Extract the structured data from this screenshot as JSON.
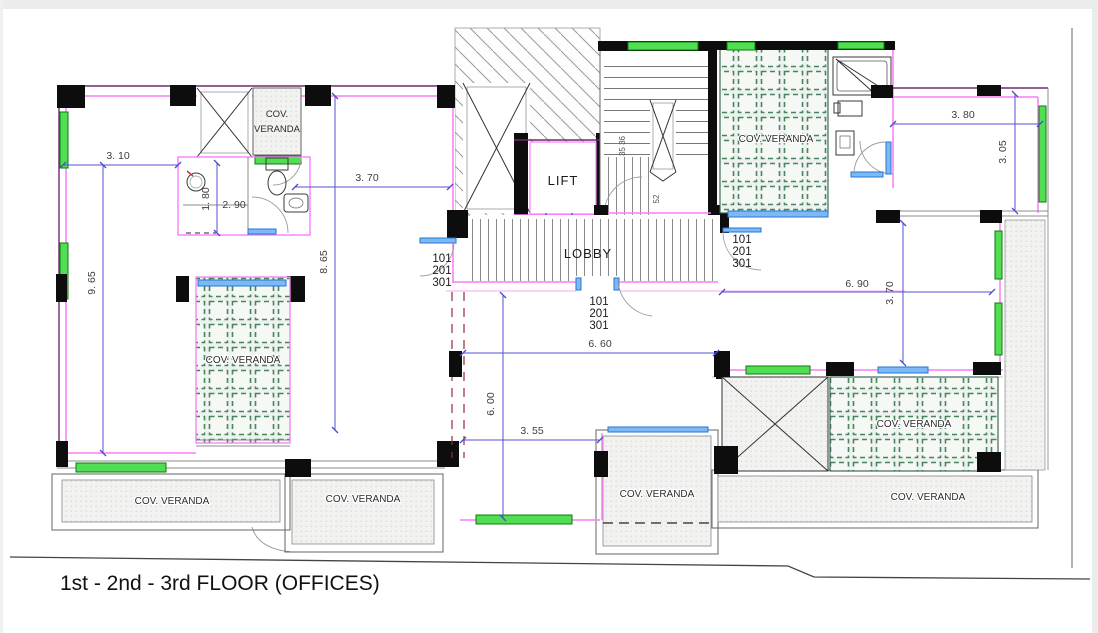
{
  "drawing": {
    "title": "1st - 2nd - 3rd FLOOR (OFFICES)"
  },
  "rooms": {
    "lift": "LIFT",
    "lobby": "LOBBY"
  },
  "veranda": {
    "label": "COV. VERANDA",
    "label_line1": "COV.",
    "label_line2": "VERANDA"
  },
  "units": {
    "floor1": "101",
    "floor2": "201",
    "floor3": "301"
  },
  "stair": {
    "steps_upper": "35 36",
    "steps_lower": "52"
  },
  "dims": {
    "w310": "3. 10",
    "h965": "9. 65",
    "h180": "1. 80",
    "w290": "2. 90",
    "w370": "3. 70",
    "h865": "8. 65",
    "w380": "3. 80",
    "h305": "3. 05",
    "w690": "6. 90",
    "h370": "3. 70",
    "w660": "6. 60",
    "h600": "6. 00",
    "w355": "3. 55"
  },
  "colors": {
    "wall_magenta": "#f97df9",
    "wall_purple": "#712a6f",
    "window_green": "#52de52",
    "door_blue": "#7db9f7",
    "dim_blue": "#5353d6",
    "column_black": "#0d0d0d",
    "veranda_green": "#47855f"
  }
}
